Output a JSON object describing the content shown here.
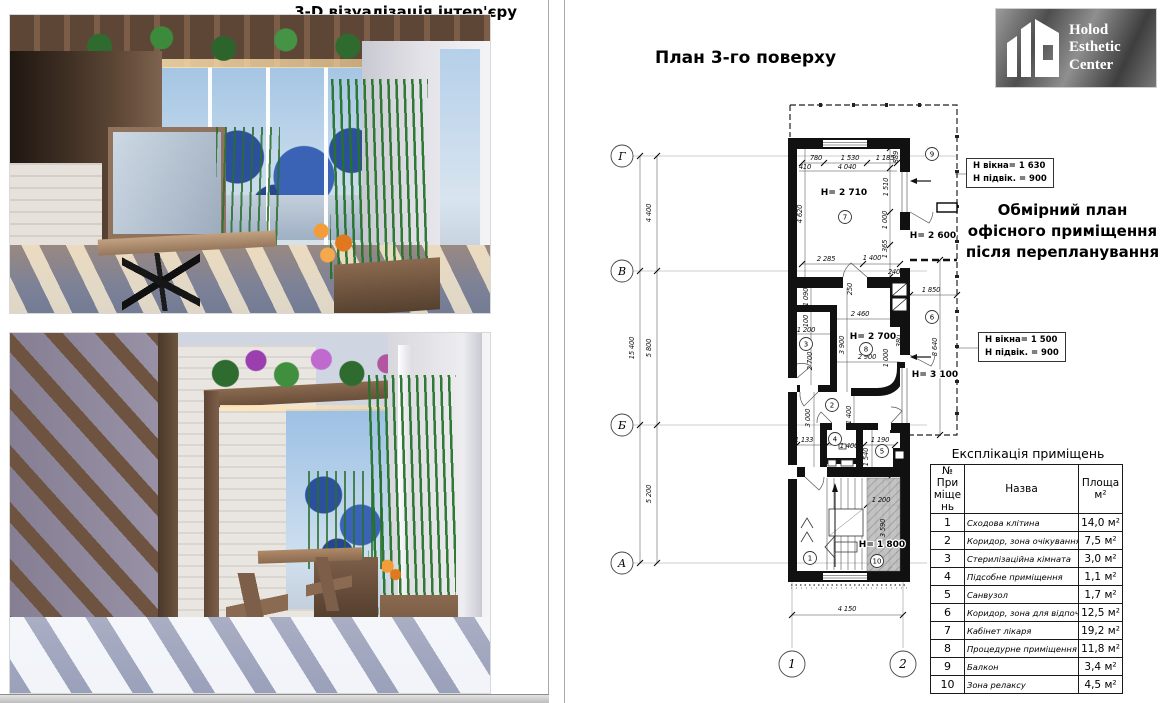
{
  "colors": {
    "wall": "#111111",
    "hatch_fill": "#bdbdbd",
    "logo_text": "#ffffff",
    "accent": "#000000"
  },
  "left": {
    "title": "3-D візуалізація інтер'єру"
  },
  "right": {
    "title": "План 3-го поверху",
    "logo": {
      "line1": "Holod",
      "line2": "Esthetic",
      "line3": "Center"
    },
    "subtitle": "Обмірний план офісного приміщення після перепланування",
    "notes": [
      {
        "l1": "Н вікна= 1 630",
        "l2": "Н підвік. = 900"
      },
      {
        "l1": "Н вікна= 1 500",
        "l2": "Н підвік. = 900"
      }
    ],
    "table": {
      "title": "Експлікація приміщень",
      "col1": "№ Приміщень",
      "col2": "Назва",
      "col3": "Площа м²",
      "rows": [
        {
          "n": "1",
          "name": "Сходова клітина",
          "area": "14,0 м²"
        },
        {
          "n": "2",
          "name": "Коридор, зона очікування",
          "area": "7,5 м²"
        },
        {
          "n": "3",
          "name": "Стерилізаційна кімната",
          "area": "3,0 м²"
        },
        {
          "n": "4",
          "name": "Підсобне приміщення",
          "area": "1,1 м²"
        },
        {
          "n": "5",
          "name": "Санвузол",
          "area": "1,7 м²"
        },
        {
          "n": "6",
          "name": "Коридор, зона для відпочинку",
          "area": "12,5 м²"
        },
        {
          "n": "7",
          "name": "Кабінет лікаря",
          "area": "19,2 м²"
        },
        {
          "n": "8",
          "name": "Процедурне приміщення",
          "area": "11,8 м²"
        },
        {
          "n": "9",
          "name": "Балкон",
          "area": "3,4 м²"
        },
        {
          "n": "10",
          "name": "Зона релаксу",
          "area": "4,5 м²"
        }
      ]
    },
    "plan": {
      "axis_rows": [
        {
          "label": "Г",
          "y": 66,
          "x2": 362
        },
        {
          "label": "В",
          "y": 181,
          "x2": 332
        },
        {
          "label": "Б",
          "y": 335,
          "x2": 332
        },
        {
          "label": "А",
          "y": 473,
          "x2": 332
        }
      ],
      "axis_cols": [
        {
          "label": "1",
          "x": 197
        },
        {
          "label": "2",
          "x": 308
        }
      ],
      "rooms": [
        {
          "n": "1",
          "x": 215,
          "y": 468
        },
        {
          "n": "2",
          "x": 237,
          "y": 315
        },
        {
          "n": "3",
          "x": 211,
          "y": 254
        },
        {
          "n": "4",
          "x": 240,
          "y": 349
        },
        {
          "n": "5",
          "x": 287,
          "y": 361
        },
        {
          "n": "6",
          "x": 337,
          "y": 227
        },
        {
          "n": "7",
          "x": 250,
          "y": 127
        },
        {
          "n": "8",
          "x": 271,
          "y": 259
        },
        {
          "n": "9",
          "x": 337,
          "y": 64
        },
        {
          "n": "10",
          "x": 282,
          "y": 471
        }
      ],
      "heights": [
        {
          "t": "H= 2 710",
          "x": 249,
          "y": 105
        },
        {
          "t": "H= 2 600",
          "x": 338,
          "y": 148
        },
        {
          "t": "H= 2 700",
          "x": 278,
          "y": 249
        },
        {
          "t": "H= 3 100",
          "x": 340,
          "y": 287
        },
        {
          "t": "H= 1 800",
          "x": 287,
          "y": 457
        }
      ],
      "dims": [
        {
          "t": "780",
          "x": 221,
          "y": 70
        },
        {
          "t": "1 530",
          "x": 255,
          "y": 70
        },
        {
          "t": "1 185",
          "x": 290,
          "y": 70
        },
        {
          "t": "410",
          "x": 210,
          "y": 79
        },
        {
          "t": "4 040",
          "x": 252,
          "y": 79
        },
        {
          "t": "889",
          "x": 303,
          "y": 67,
          "r": 1
        },
        {
          "t": "4 620",
          "x": 207,
          "y": 124,
          "r": 1
        },
        {
          "t": "1 510",
          "x": 293,
          "y": 97,
          "r": 1
        },
        {
          "t": "1 000",
          "x": 292,
          "y": 130,
          "r": 1
        },
        {
          "t": "1 365",
          "x": 292,
          "y": 159,
          "r": 1
        },
        {
          "t": "2 285",
          "x": 231,
          "y": 171
        },
        {
          "t": "1 400",
          "x": 277,
          "y": 170
        },
        {
          "t": "240",
          "x": 299,
          "y": 184
        },
        {
          "t": "1 090",
          "x": 213,
          "y": 207,
          "r": 1
        },
        {
          "t": "250",
          "x": 257,
          "y": 199,
          "r": 1
        },
        {
          "t": "2 460",
          "x": 265,
          "y": 226
        },
        {
          "t": "100",
          "x": 213,
          "y": 231,
          "r": 1
        },
        {
          "t": "1 200",
          "x": 211,
          "y": 242
        },
        {
          "t": "3 900",
          "x": 249,
          "y": 255,
          "r": 1
        },
        {
          "t": "2 700",
          "x": 217,
          "y": 271,
          "r": 1
        },
        {
          "t": "2 900",
          "x": 272,
          "y": 269
        },
        {
          "t": "1 000",
          "x": 293,
          "y": 268,
          "r": 1
        },
        {
          "t": "380",
          "x": 306,
          "y": 251,
          "r": 1
        },
        {
          "t": "1 850",
          "x": 336,
          "y": 202
        },
        {
          "t": "8 640",
          "x": 342,
          "y": 257,
          "r": 1
        },
        {
          "t": "3 000",
          "x": 215,
          "y": 328,
          "r": 1
        },
        {
          "t": "1 400",
          "x": 256,
          "y": 325,
          "r": 1
        },
        {
          "t": "1 133",
          "x": 209,
          "y": 352
        },
        {
          "t": "1 400",
          "x": 254,
          "y": 358
        },
        {
          "t": "1 190",
          "x": 285,
          "y": 352
        },
        {
          "t": "1 540",
          "x": 273,
          "y": 367,
          "r": 1
        },
        {
          "t": "1 200",
          "x": 286,
          "y": 412
        },
        {
          "t": "3 590",
          "x": 290,
          "y": 438,
          "r": 1
        },
        {
          "t": "4 150",
          "x": 252,
          "y": 521
        },
        {
          "t": "4 400",
          "x": 56,
          "y": 123,
          "r": 1
        },
        {
          "t": "15 400",
          "x": 39,
          "y": 258,
          "r": 1
        },
        {
          "t": "5 800",
          "x": 56,
          "y": 258,
          "r": 1
        },
        {
          "t": "5 200",
          "x": 56,
          "y": 404,
          "r": 1
        }
      ]
    }
  }
}
